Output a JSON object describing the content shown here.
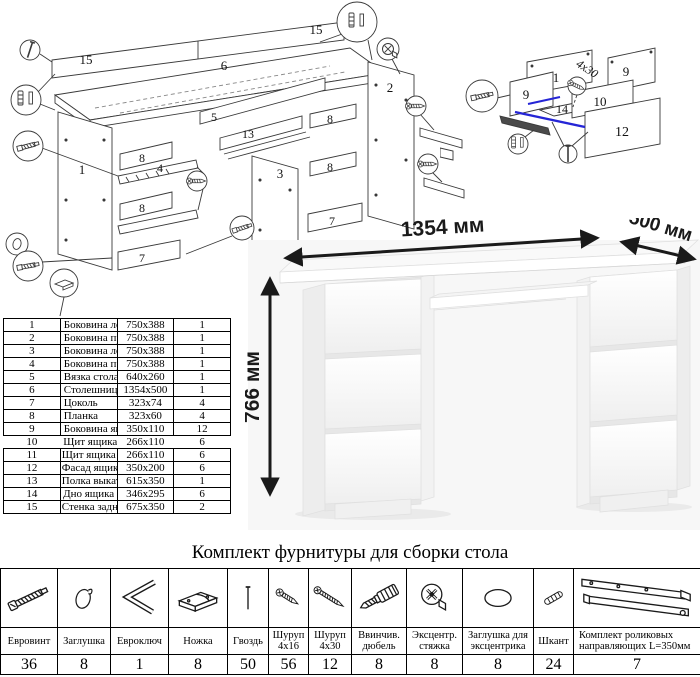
{
  "document": {
    "type": "furniture-assembly-sheet",
    "line_color": "#3a3a3a",
    "accent_blue": "#2525d6"
  },
  "diagrams": {
    "desk": {
      "labels": [
        "15",
        "15",
        "6",
        "5",
        "13",
        "3",
        "2",
        "1",
        "4",
        "8",
        "8",
        "7",
        "8",
        "8",
        "7"
      ]
    },
    "drawer": {
      "labels": [
        "11",
        "9",
        "9",
        "10",
        "14",
        "12"
      ],
      "screw_note": "4x30"
    }
  },
  "parts_table": {
    "rows": [
      {
        "num": "1",
        "name": "Боковина левая",
        "size": "750x388",
        "qty": "1"
      },
      {
        "num": "2",
        "name": "Боковина правая",
        "size": "750x388",
        "qty": "1"
      },
      {
        "num": "3",
        "name": "Боковина левая",
        "size": "750x388",
        "qty": "1"
      },
      {
        "num": "4",
        "name": "Боковина правая",
        "size": "750x388",
        "qty": "1"
      },
      {
        "num": "5",
        "name": "Вязка стола",
        "size": "640x260",
        "qty": "1"
      },
      {
        "num": "6",
        "name": "Столешница",
        "size": "1354x500",
        "qty": "1"
      },
      {
        "num": "7",
        "name": "Цоколь",
        "size": "323x74",
        "qty": "4"
      },
      {
        "num": "8",
        "name": "Планка",
        "size": "323x60",
        "qty": "4"
      },
      {
        "num": "9",
        "name": "Боковина ящика",
        "size": "350x110",
        "qty": "12"
      },
      {
        "num": "10",
        "name": "Щит ящика передний",
        "size": "266x110",
        "qty": "6"
      },
      {
        "num": "11",
        "name": "Щит ящика задний",
        "size": "266x110",
        "qty": "6"
      },
      {
        "num": "12",
        "name": "Фасад ящика",
        "size": "350x200",
        "qty": "6"
      },
      {
        "num": "13",
        "name": "Полка выкатная",
        "size": "615x350",
        "qty": "1"
      },
      {
        "num": "14",
        "name": "Дно ящика",
        "size": "346x295",
        "qty": "6"
      },
      {
        "num": "15",
        "name": "Стенка задняя",
        "size": "675x350",
        "qty": "2"
      }
    ]
  },
  "product_view": {
    "width_label": "1354 мм",
    "depth_label": "500 мм",
    "height_label": "766 мм",
    "background": "#f7f7f7",
    "desk_color": "#ffffff"
  },
  "hardware": {
    "title": "Комплект фурнитуры для сборки стола",
    "items": [
      {
        "icon": "euro-screw-icon",
        "name": "Евровинт",
        "qty": "36"
      },
      {
        "icon": "cap-icon",
        "name": "Заглушка",
        "qty": "8"
      },
      {
        "icon": "hex-key-icon",
        "name": "Евроключ",
        "qty": "1"
      },
      {
        "icon": "foot-icon",
        "name": "Ножка",
        "qty": "8"
      },
      {
        "icon": "nail-icon",
        "name": "Гвоздь",
        "qty": "50"
      },
      {
        "icon": "screw-16-icon",
        "name": "Шуруп 4x16",
        "qty": "56"
      },
      {
        "icon": "screw-30-icon",
        "name": "Шуруп 4x30",
        "qty": "12"
      },
      {
        "icon": "dowel-screw-icon",
        "name": "Ввинчив. дюбель",
        "qty": "8"
      },
      {
        "icon": "cam-lock-icon",
        "name": "Эксцентр. стяжка",
        "qty": "8"
      },
      {
        "icon": "cam-cap-icon",
        "name": "Заглушка для эксцентрика",
        "qty": "8"
      },
      {
        "icon": "wood-dowel-icon",
        "name": "Шкант",
        "qty": "24"
      },
      {
        "icon": "drawer-slide-icon",
        "name": "Комплект роликовых направляющих L=350мм",
        "qty": "7"
      }
    ]
  }
}
